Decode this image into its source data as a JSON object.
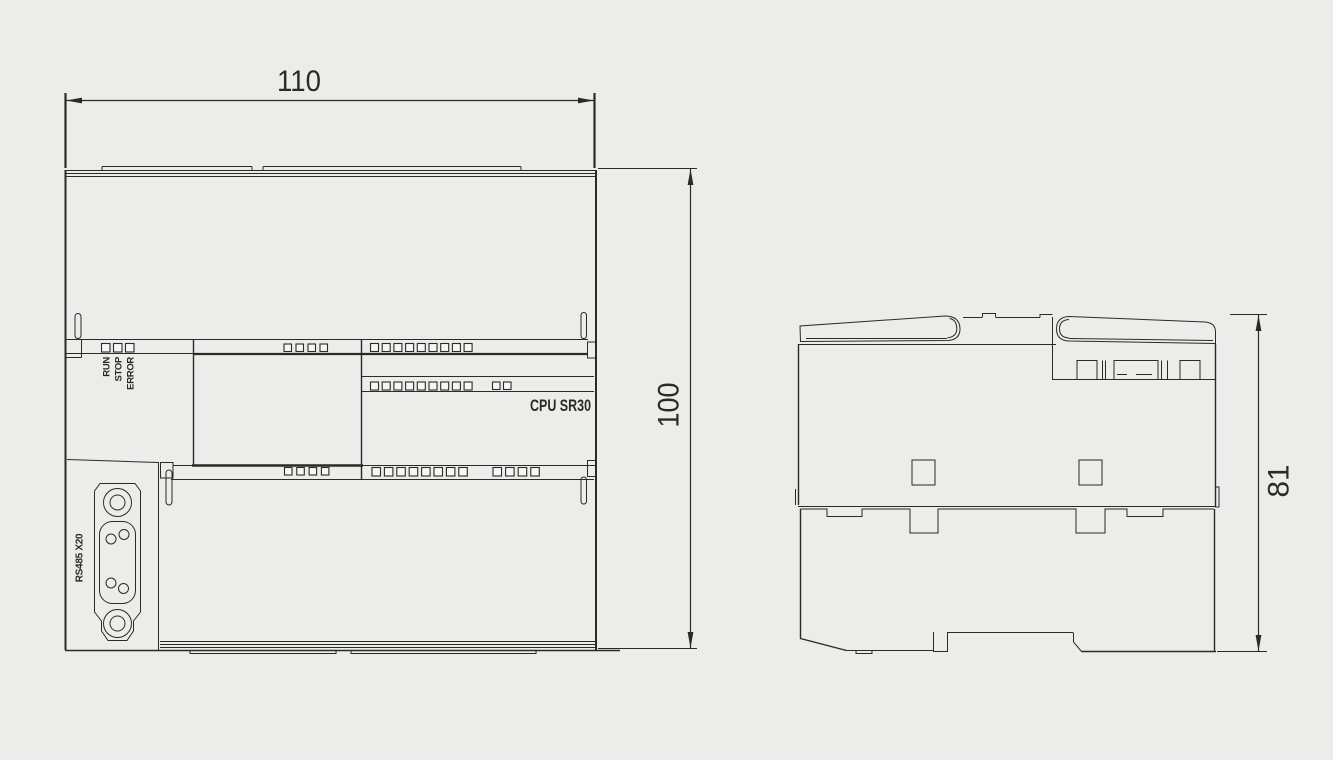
{
  "colors": {
    "background": "#ececeb",
    "line": "#2d2926",
    "square-fill": "#f6f6f5"
  },
  "front_view": {
    "width_dimension": "110",
    "height_dimension": "100",
    "model_label": "CPU SR30",
    "led_labels": [
      "RUN",
      "STOP",
      "ERROR"
    ],
    "port_label": "RS485 X20",
    "terminal_squares": {
      "led_row": {
        "count": 3,
        "x": 101.5,
        "y": 343.5,
        "size": 8.5,
        "step": 12
      },
      "top_mid": {
        "count": 4,
        "x": 284,
        "y": 344,
        "size": 7.5,
        "step": 12
      },
      "top_right": {
        "count": 9,
        "x": 370.5,
        "y": 343.5,
        "size": 8,
        "step": 11.7
      },
      "mid_right_a": {
        "count": 9,
        "x": 370.5,
        "y": 382,
        "size": 8,
        "step": 11.7
      },
      "mid_right_b": {
        "count": 2,
        "x": 492.5,
        "y": 382,
        "size": 7.5,
        "step": 11
      },
      "bot_mid": {
        "count": 4,
        "x": 284.5,
        "y": 467.5,
        "size": 7.5,
        "step": 12.3
      },
      "bot_right_a": {
        "count": 8,
        "x": 372,
        "y": 467.5,
        "size": 8.5,
        "step": 12.4
      },
      "bot_right_b": {
        "count": 4,
        "x": 493,
        "y": 467.5,
        "size": 8.5,
        "step": 12.6
      }
    }
  },
  "side_view": {
    "depth_dimension": "81"
  }
}
